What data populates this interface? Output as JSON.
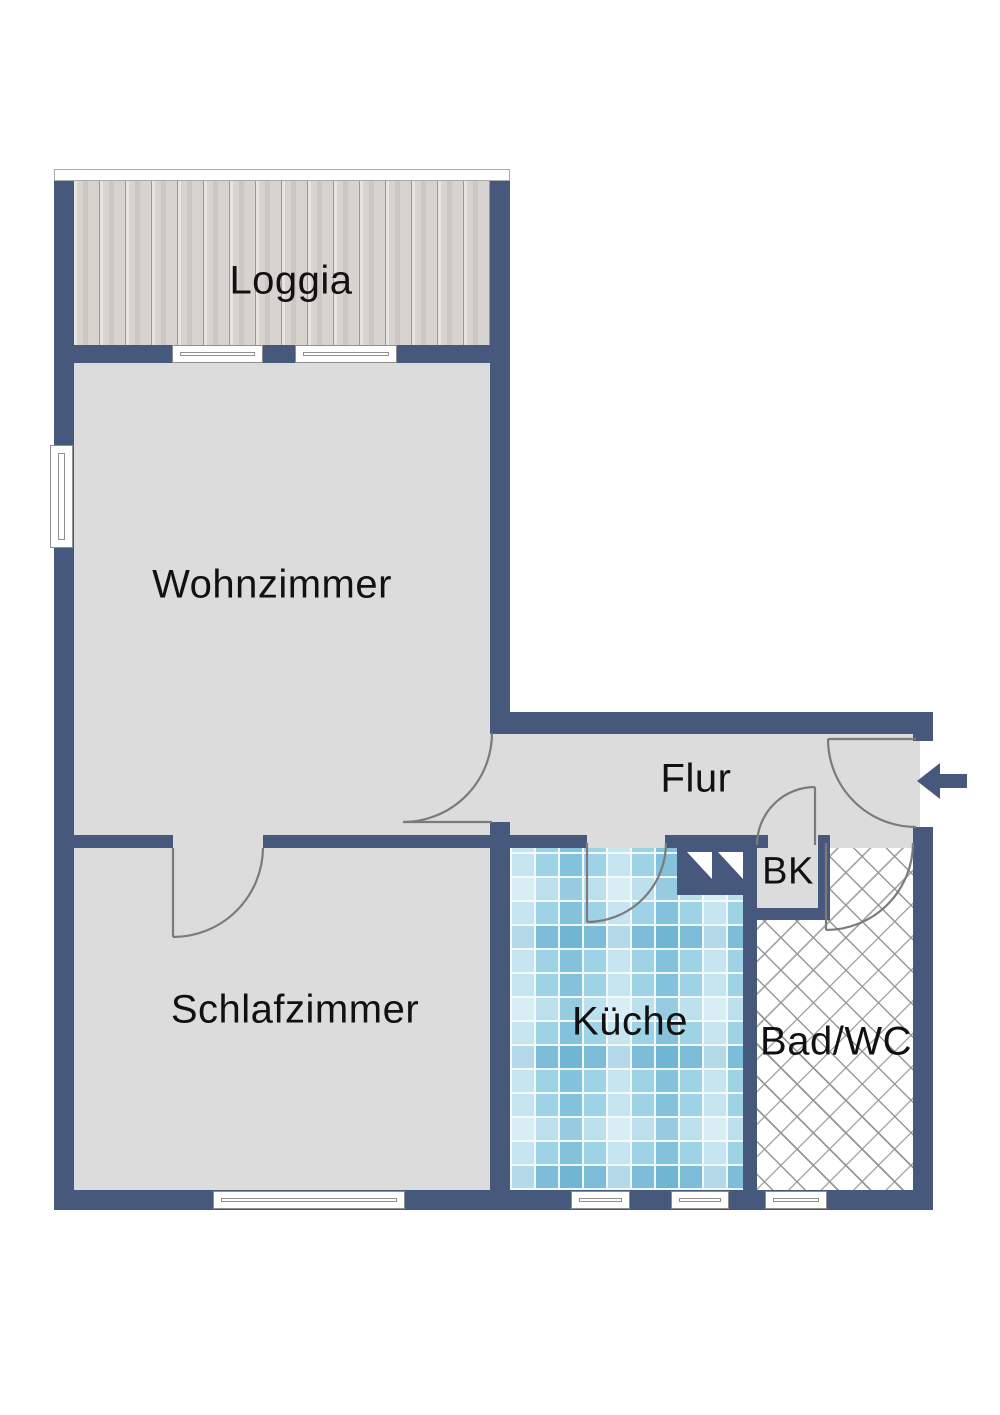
{
  "rooms": {
    "loggia": {
      "label": "Loggia"
    },
    "wohnzimmer": {
      "label": "Wohnzimmer"
    },
    "flur": {
      "label": "Flur"
    },
    "bk": {
      "label": "BK"
    },
    "kueche": {
      "label": "Küche"
    },
    "badwc": {
      "label": "Bad/WC"
    },
    "schlafzimmer": {
      "label": "Schlafzimmer"
    }
  },
  "entrance": {
    "direction": "left"
  },
  "colors": {
    "wall": "#46597d",
    "floor": "#dcdcdc",
    "door_arc": "#7b7b7b",
    "window_frame": "#8f8f8f",
    "text": "#111111",
    "kitchen_tile": "#9ed2e6",
    "bath_hatch_line": "#969696",
    "loggia_wood": "#d9d3cf"
  }
}
